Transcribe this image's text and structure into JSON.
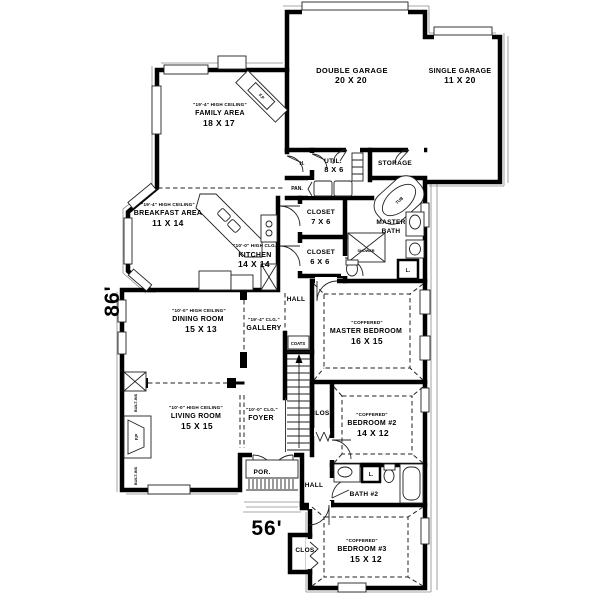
{
  "plan": {
    "width_label": "56'",
    "height_label": "86'"
  },
  "rooms": {
    "double_garage": {
      "name": "DOUBLE GARAGE",
      "dims": "20 X 20"
    },
    "single_garage": {
      "name": "SINGLE GARAGE",
      "dims": "11 X 20"
    },
    "family": {
      "ceiling": "\"19'-4\" HIGH CEILING\"",
      "name": "FAMILY AREA",
      "dims": "18 X 17"
    },
    "breakfast": {
      "ceiling": "\"19'-4\" HIGH CEILING\"",
      "name": "BREAKFAST AREA",
      "dims": "11 X 14"
    },
    "kitchen": {
      "ceiling": "\"10'-0\" HIGH CLG.\"",
      "name": "KITCHEN",
      "dims": "14 X 14"
    },
    "dining": {
      "ceiling": "\"10'-0\" HIGH CEILING\"",
      "name": "DINING ROOM",
      "dims": "15 X 13"
    },
    "living": {
      "ceiling": "\"10'-0\" HIGH CEILING\"",
      "name": "LIVING ROOM",
      "dims": "15 X 15"
    },
    "master_bedroom": {
      "ceiling": "\"COFFERED\"",
      "name": "MASTER BEDROOM",
      "dims": "16 X 15"
    },
    "bedroom2": {
      "ceiling": "\"COFFERED\"",
      "name": "BEDROOM #2",
      "dims": "14 X 12"
    },
    "bedroom3": {
      "ceiling": "\"COFFERED\"",
      "name": "BEDROOM #3",
      "dims": "15 X 12"
    },
    "utility": {
      "name": "UTIL.",
      "dims": "8 X 6"
    },
    "storage": {
      "name": "STORAGE"
    },
    "closet_7x6": {
      "name": "CLOSET",
      "dims": "7 X 6"
    },
    "closet_6x6": {
      "name": "CLOSET",
      "dims": "6 X 6"
    },
    "master_bath": {
      "line1": "MASTER",
      "line2": "BATH"
    },
    "bath2": {
      "name": "BATH #2"
    },
    "gallery": {
      "ceiling": "\"19'-4\" CLG.\"",
      "name": "GALLERY"
    },
    "foyer": {
      "ceiling": "\"10'-0\" CLG.\"",
      "name": "FOYER"
    },
    "porch": {
      "name": "POR."
    }
  },
  "labels": {
    "hall_center": "HALL",
    "hall_rear": "HALL",
    "coats": "COATS",
    "pantry": "PAN.",
    "hall_abbrev": "H.",
    "tub": "TUB",
    "shower": "SHOWER",
    "linen_master": "L.",
    "linen_bath2": "L.",
    "closet_bedroom2": "CLOS.",
    "closet_bedroom3": "CLOS.",
    "fireplace_family": "F.P",
    "fireplace_living": "F.P",
    "builtins_upper": "BUILT-INS",
    "builtins_lower": "BUILT-INS"
  },
  "colors": {
    "wall": "#000000",
    "thin_line": "#222222",
    "background": "#ffffff"
  }
}
